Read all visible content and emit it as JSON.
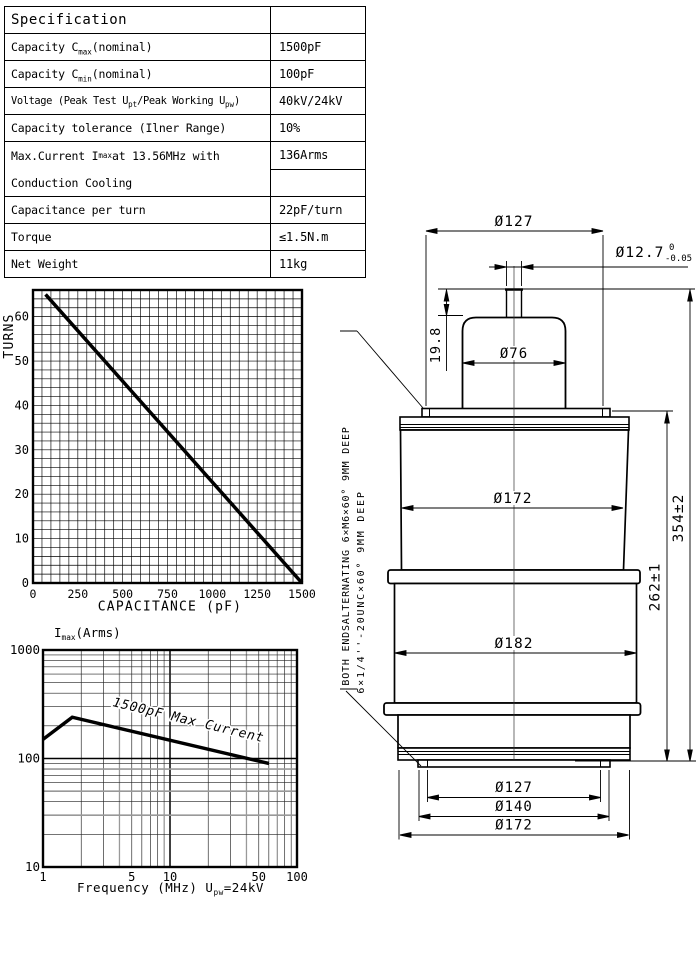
{
  "table": {
    "title": "Specification",
    "rows": [
      {
        "label": [
          {
            "t": "Capacity C"
          },
          {
            "s": "max"
          },
          {
            "t": "(nominal)"
          }
        ],
        "value": "1500pF"
      },
      {
        "label": [
          {
            "t": "Capacity C"
          },
          {
            "s": "min"
          },
          {
            "t": "(nominal)"
          }
        ],
        "value": "100pF"
      },
      {
        "label": [
          {
            "t": "Voltage (Peak Test U"
          },
          {
            "s": "pt"
          },
          {
            "t": "/Peak Working U"
          },
          {
            "s": "pw"
          },
          {
            "t": ")"
          }
        ],
        "value": "40kV/24kV"
      },
      {
        "label": [
          {
            "t": "Capacity tolerance (Ilner Range)"
          }
        ],
        "value": "10%"
      },
      {
        "label": [
          {
            "t": "Max.Current I"
          },
          {
            "s": "max"
          },
          {
            "t": " at 13.56MHz with"
          }
        ],
        "label2": "Conduction Cooling",
        "value": "136Arms",
        "value2": ""
      },
      {
        "label": [
          {
            "t": "Capacitance per turn"
          }
        ],
        "value": "22pF/turn"
      },
      {
        "label": [
          {
            "t": "Torque"
          }
        ],
        "value": "≤1.5N.m"
      },
      {
        "label": [
          {
            "t": "Net Weight"
          }
        ],
        "value": "11kg"
      }
    ]
  },
  "chart_data": [
    {
      "type": "line",
      "title": "",
      "xlabel": "CAPACITANCE (pF)",
      "ylabel": "TURNS",
      "xlim": [
        0,
        1500
      ],
      "ylim": [
        0,
        66
      ],
      "x_ticks": [
        0,
        250,
        500,
        750,
        1000,
        1250,
        1500
      ],
      "y_ticks": [
        0,
        10,
        20,
        30,
        40,
        50,
        60
      ],
      "x_minor_step": 50,
      "y_minor_step": 2,
      "grid": true,
      "legend": "none",
      "series": [
        {
          "name": "turns-vs-capacitance",
          "points": [
            [
              70,
              65
            ],
            [
              1500,
              0
            ]
          ]
        }
      ]
    },
    {
      "type": "line",
      "xscale": "log",
      "yscale": "log",
      "xlabel_parts": {
        "pre": "Frequency (MHz) U",
        "sub": "pw",
        "post": "=24kV"
      },
      "ylabel_parts": {
        "pre": "I",
        "sub": "max",
        "post": "(Arms)"
      },
      "xlim": [
        1,
        100
      ],
      "ylim": [
        10,
        1000
      ],
      "x_ticks": [
        1,
        5,
        10,
        50,
        100
      ],
      "y_ticks": [
        10,
        100,
        1000
      ],
      "grid": true,
      "annotation": "1500pF Max Current",
      "series": [
        {
          "name": "max-current-vs-frequency",
          "points": [
            [
              1,
              150
            ],
            [
              1.7,
              240
            ],
            [
              60,
              90
            ]
          ]
        }
      ]
    }
  ],
  "drawing": {
    "dims": {
      "d127_top": "Ø127",
      "d12_7": "Ø12.7",
      "d12_7_tol_hi": "0",
      "d12_7_tol_lo": "-0.05",
      "h19_8": "19.8",
      "d76": "Ø76",
      "d172_mid": "Ø172",
      "d182": "Ø182",
      "h354": "354±2",
      "h262": "262±1",
      "d127_bot": "Ø127",
      "d140": "Ø140",
      "d172_bot": "Ø172"
    },
    "notes": [
      "BOTH ENDSALTERNATING 6×M6×60° 9MM DEEP",
      "6×1/4''-20UNC×60° 9MM DEEP"
    ]
  }
}
